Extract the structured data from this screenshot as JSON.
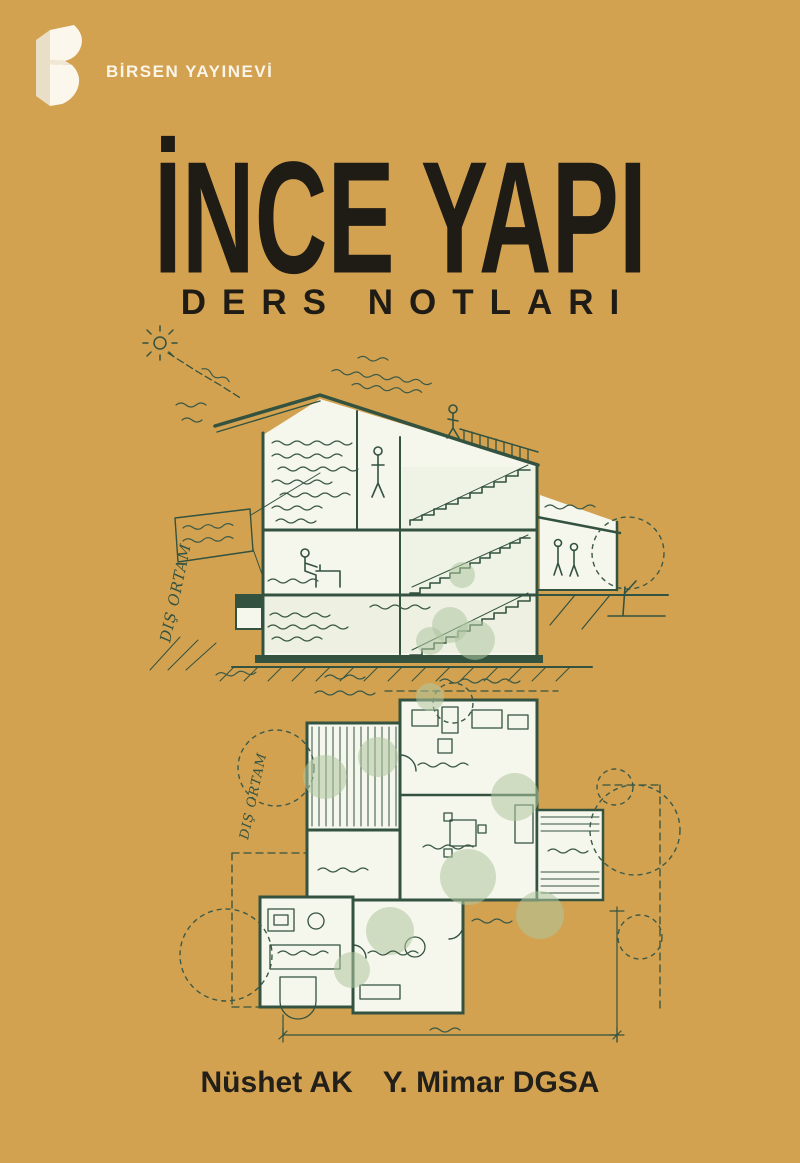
{
  "cover": {
    "publisher": {
      "name": "BİRSEN YAYINEVİ",
      "logo_icon": "birsen-3d-b-logo"
    },
    "title": "İNCE YAPI",
    "subtitle": "DERS NOTLARI",
    "authors": {
      "name": "Nüshet AK",
      "credential": "Y. Mimar DGSA"
    },
    "artwork_labels": {
      "section_side": "DIŞ ORTAM",
      "plan_side": "DIŞ ORTAM"
    },
    "colors": {
      "background": "#D3A251",
      "title_text": "#1F1B15",
      "publisher_text": "#FAF5E8",
      "drawing_ink": "#33523F",
      "drawing_paper": "#F5F6EC",
      "drawing_foliage": "#AFC6A0"
    }
  }
}
